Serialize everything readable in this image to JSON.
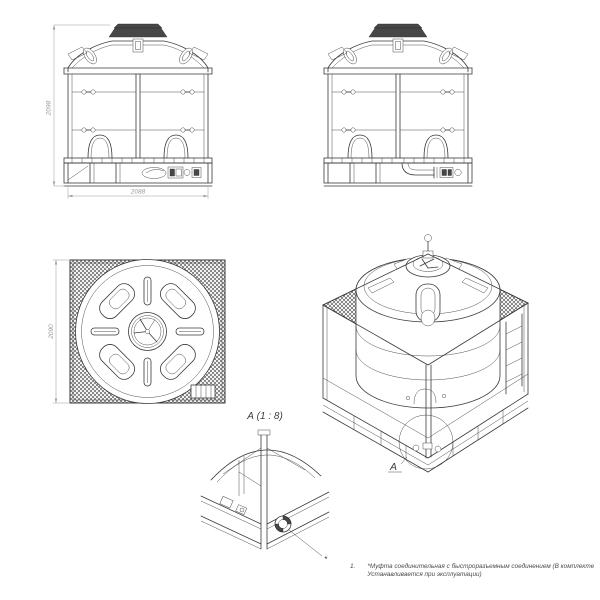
{
  "sheet": {
    "background": "#ffffff",
    "line_color": "#3a3a3a",
    "dim_color": "#9a9a9a"
  },
  "views": {
    "front": {
      "height_dim": "2098",
      "width_dim": "2088"
    },
    "top": {
      "depth_dim": "2090"
    },
    "isometric": {
      "callout_label": "А"
    },
    "detail": {
      "title": "А (1 : 8)",
      "note_marker": "*"
    }
  },
  "footnote": {
    "number": "1.",
    "line1": "*Муфта соединительная с быстроразъемным соединением (В комплекте",
    "line2": "Устанавливается при эксплуатации)"
  }
}
